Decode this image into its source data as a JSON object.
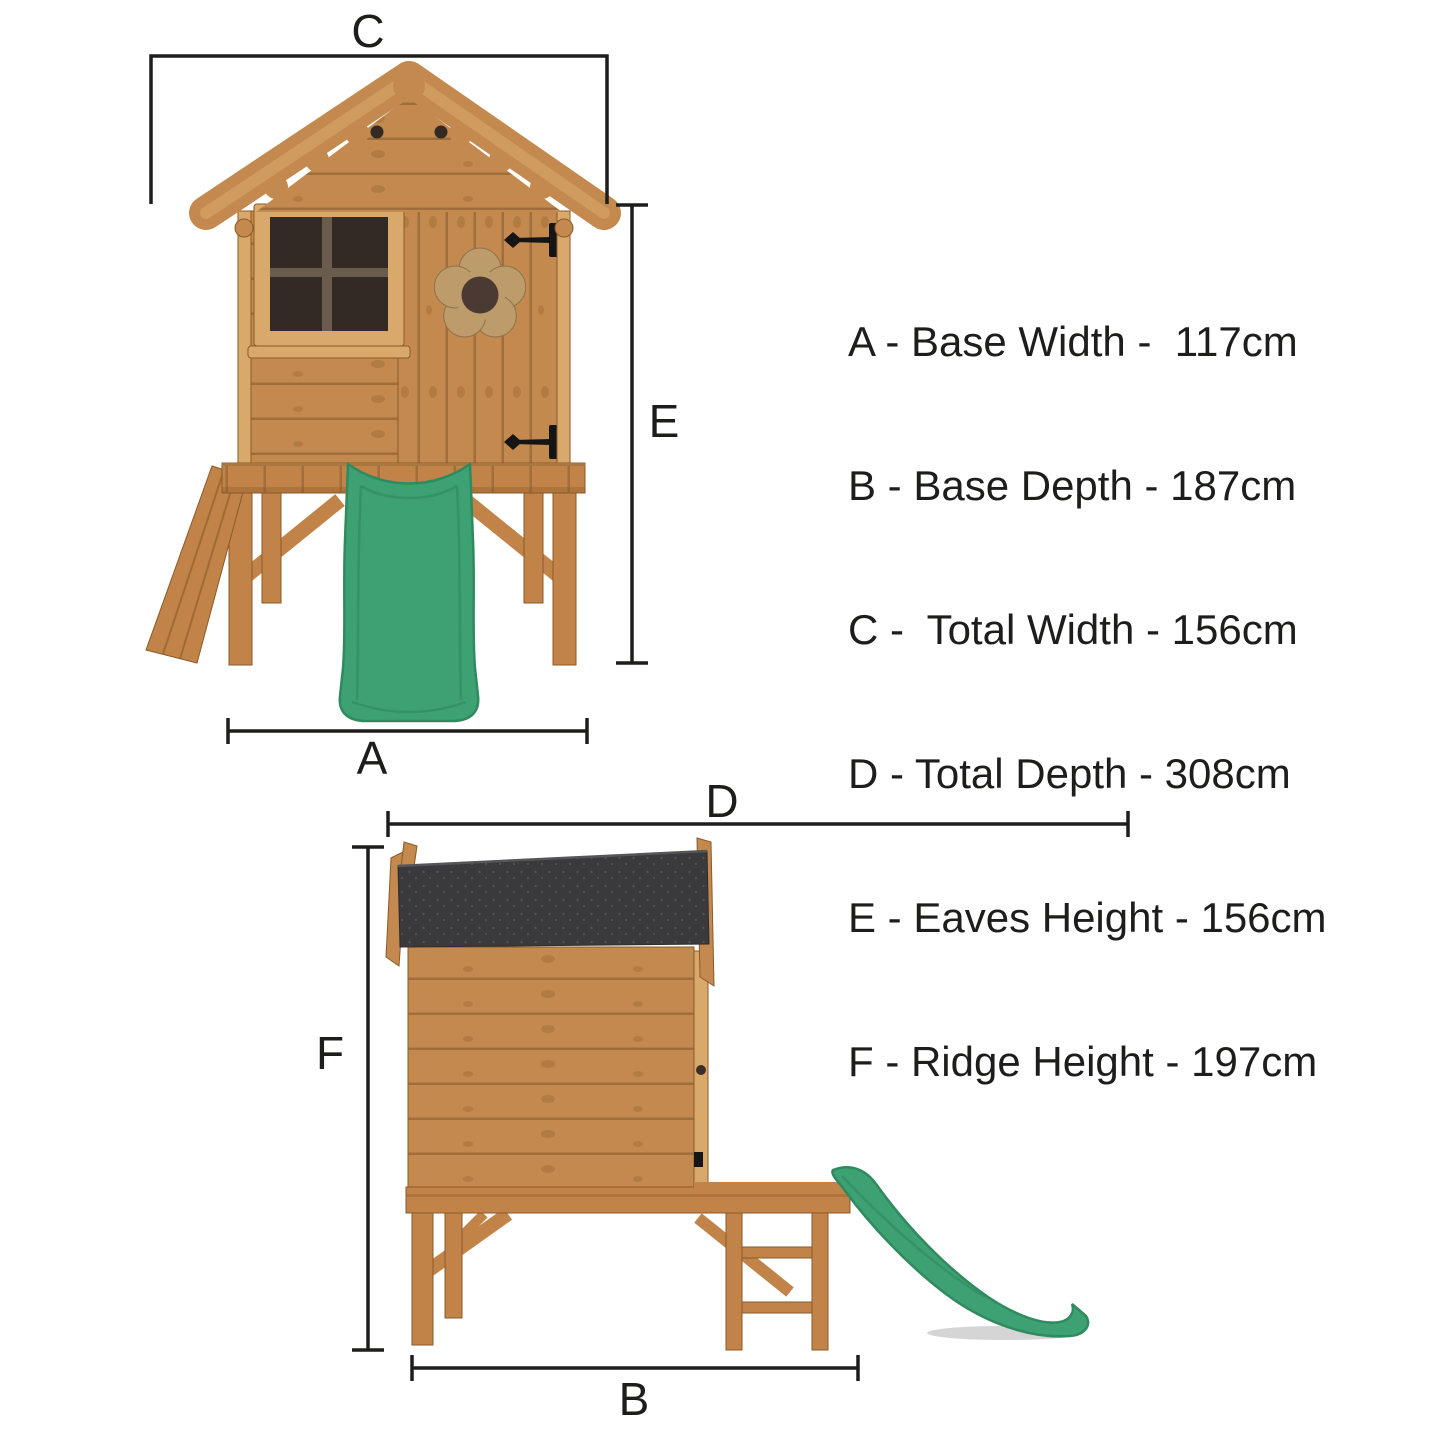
{
  "figure": {
    "type": "product-dimension-diagram",
    "subject": "wooden playhouse on stilts with green slide, front and side elevations",
    "views": [
      {
        "name": "front-elevation"
      },
      {
        "name": "side-elevation"
      }
    ]
  },
  "dimensions": [
    {
      "letter": "A",
      "name": "Base Width",
      "value": "117cm",
      "text": "A - Base Width -  117cm"
    },
    {
      "letter": "B",
      "name": "Base Depth",
      "value": "187cm",
      "text": "B - Base Depth - 187cm"
    },
    {
      "letter": "C",
      "name": "Total Width",
      "value": "156cm",
      "text": "C -  Total Width - 156cm"
    },
    {
      "letter": "D",
      "name": "Total Depth",
      "value": "308cm",
      "text": "D - Total Depth - 308cm"
    },
    {
      "letter": "E",
      "name": "Eaves Height",
      "value": "156cm",
      "text": "E - Eaves Height - 156cm"
    },
    {
      "letter": "F",
      "name": "Ridge Height",
      "value": "197cm",
      "text": "F - Ridge Height - 197cm"
    }
  ],
  "colors": {
    "bg": "#ffffff",
    "ink": "#1d1d1b",
    "wood_mid": "#c4894e",
    "wood_light": "#d9a96b",
    "wood_deck": "#c18348",
    "wood_line": "#9a6a38",
    "wood_dark": "#8a5a28",
    "wood_flower": "#bd9b6a",
    "roof_felt": "#3a3a3c",
    "roof_dot": "#6d6d72",
    "slide": "#3ea173",
    "slide_dark": "#2f8a5f",
    "window": "#332a24",
    "hinge": "#151515",
    "shadow": "#d5d5d5"
  }
}
